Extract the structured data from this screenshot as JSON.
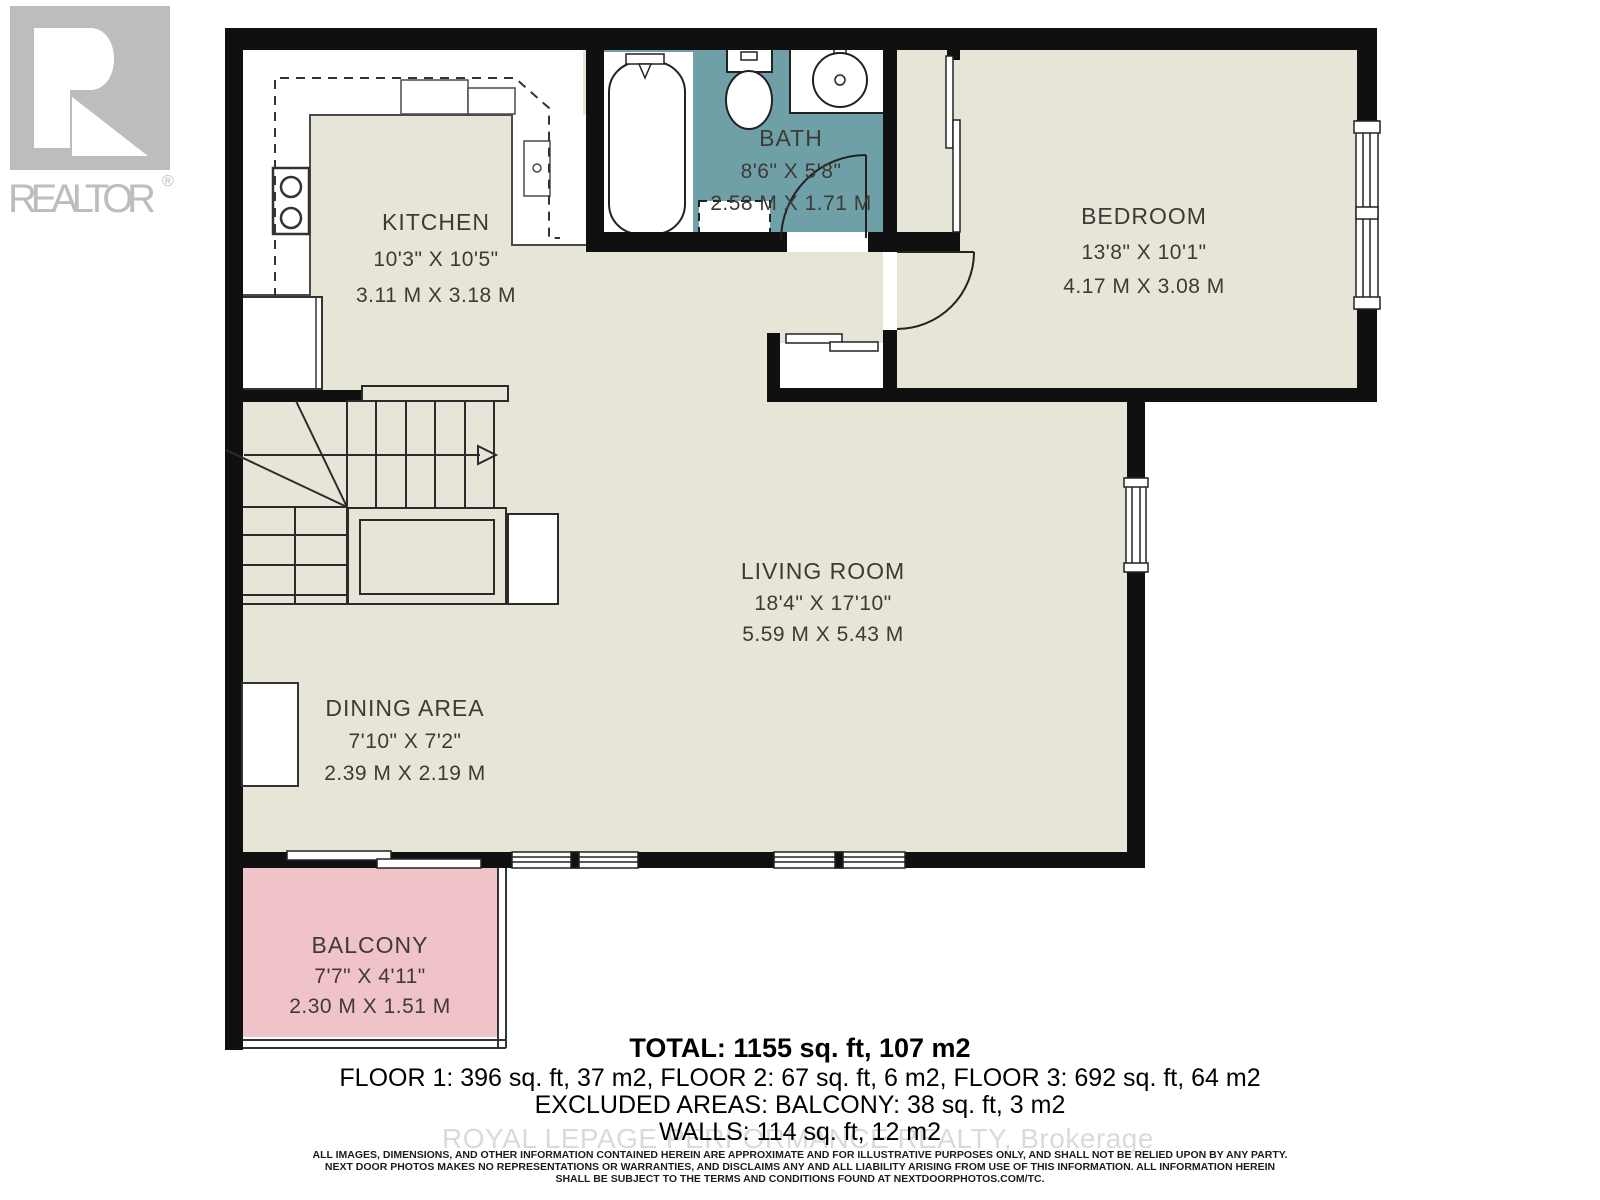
{
  "branding": {
    "logo_text": "REALTOR",
    "registered_mark": "®",
    "watermark": "ROYAL LEPAGE PERFORMANCE REALTY, Brokerage"
  },
  "rooms": {
    "kitchen": {
      "name": "KITCHEN",
      "imperial": "10'3\" X 10'5\"",
      "metric": "3.11 M X 3.18 M"
    },
    "bath": {
      "name": "BATH",
      "imperial": "8'6\" X 5'8\"",
      "metric": "2.58 M X 1.71 M"
    },
    "bedroom": {
      "name": "BEDROOM",
      "imperial": "13'8\" X 10'1\"",
      "metric": "4.17 M X 3.08 M"
    },
    "living_room": {
      "name": "LIVING ROOM",
      "imperial": "18'4\" X 17'10\"",
      "metric": "5.59 M X 5.43 M"
    },
    "dining_area": {
      "name": "DINING AREA",
      "imperial": "7'10\" X 7'2\"",
      "metric": "2.39 M X 2.19 M"
    },
    "balcony": {
      "name": "BALCONY",
      "imperial": "7'7\" X 4'11\"",
      "metric": "2.30 M X 1.51 M"
    }
  },
  "summary": {
    "total": "TOTAL: 1155 sq. ft, 107 m2",
    "floors": "FLOOR 1: 396 sq. ft, 37 m2, FLOOR 2: 67 sq. ft, 6 m2, FLOOR 3: 692 sq. ft, 64 m2",
    "excluded": "EXCLUDED AREAS: BALCONY: 38 sq. ft, 3 m2",
    "walls": "WALLS: 114 sq. ft, 12 m2"
  },
  "disclaimer": {
    "line1": "ALL IMAGES, DIMENSIONS, AND OTHER INFORMATION CONTAINED HEREIN ARE APPROXIMATE AND FOR ILLUSTRATIVE PURPOSES ONLY, AND SHALL NOT BE RELIED UPON BY ANY PARTY.",
    "line2": "NEXT DOOR PHOTOS MAKES NO REPRESENTATIONS OR WARRANTIES, AND DISCLAIMS ANY AND ALL LIABILITY ARISING FROM USE OF THIS INFORMATION. ALL INFORMATION HEREIN",
    "line3": "SHALL BE SUBJECT TO THE TERMS AND CONDITIONS FOUND AT NEXTDOORPHOTOS.COM/TC."
  },
  "colors": {
    "wall": "#101010",
    "floor": "#e7e4d8",
    "bath": "#6fa0a8",
    "balcony": "#f0c3c8",
    "fixture_line": "#2b2b2b",
    "label": "#3e3a35",
    "watermark": "#c2c2c2",
    "logo_gray": "#bdbdbd"
  }
}
